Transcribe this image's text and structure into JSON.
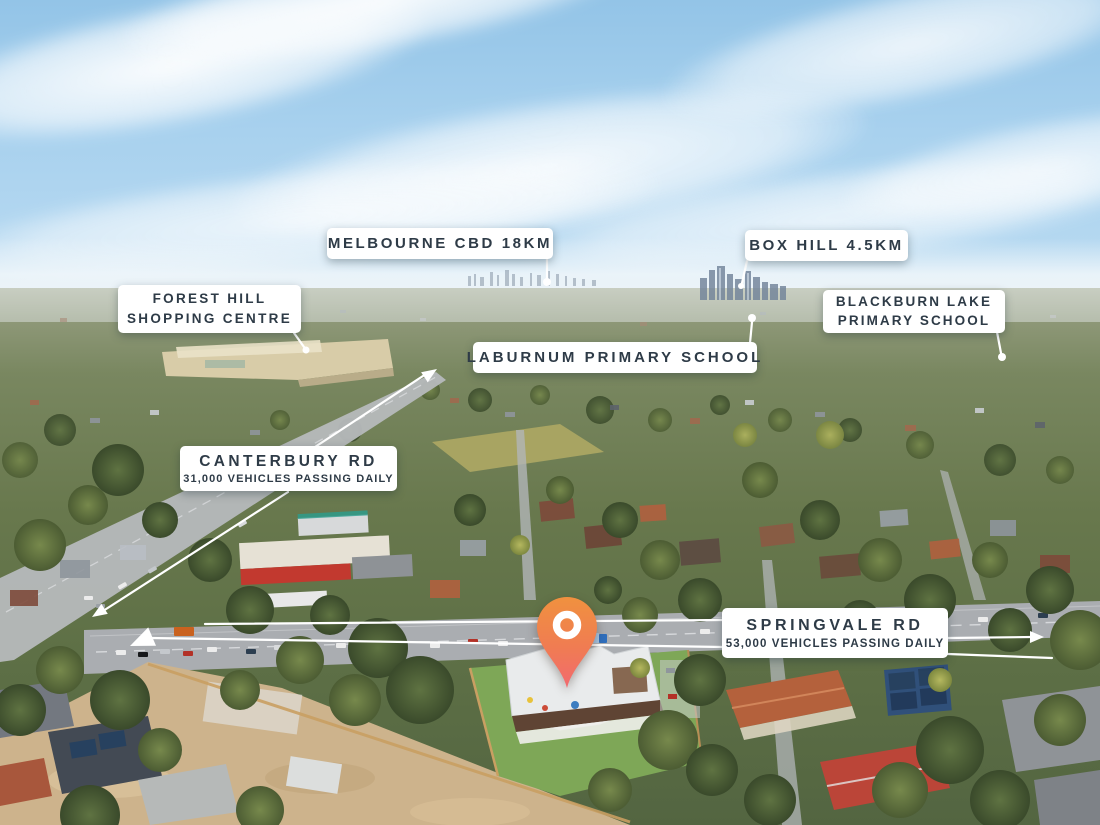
{
  "labels": {
    "melbourne_cbd": {
      "text": "MELBOURNE CBD 18KM"
    },
    "box_hill": {
      "text": "BOX HILL 4.5KM"
    },
    "forest_hill": {
      "line1": "FOREST HILL",
      "line2": "SHOPPING CENTRE"
    },
    "blackburn_lake": {
      "line1": "BLACKBURN LAKE",
      "line2": "PRIMARY SCHOOL"
    },
    "laburnum": {
      "text": "LABURNUM PRIMARY SCHOOL"
    },
    "canterbury_rd": {
      "title": "CANTERBURY RD",
      "subtitle": "31,000 VEHICLES PASSING DAILY"
    },
    "springvale_rd": {
      "title": "SPRINGVALE RD",
      "subtitle": "53,000 VEHICLES PASSING DAILY"
    }
  },
  "marker": {
    "type": "location-pin",
    "color_top": "#f0913f",
    "color_bottom": "#f26a70",
    "ring_color": "#ffffff"
  },
  "annotation_style": {
    "label_background": "#ffffff",
    "label_text_color": "#2e3b47",
    "leader_line_color": "#ffffff"
  }
}
